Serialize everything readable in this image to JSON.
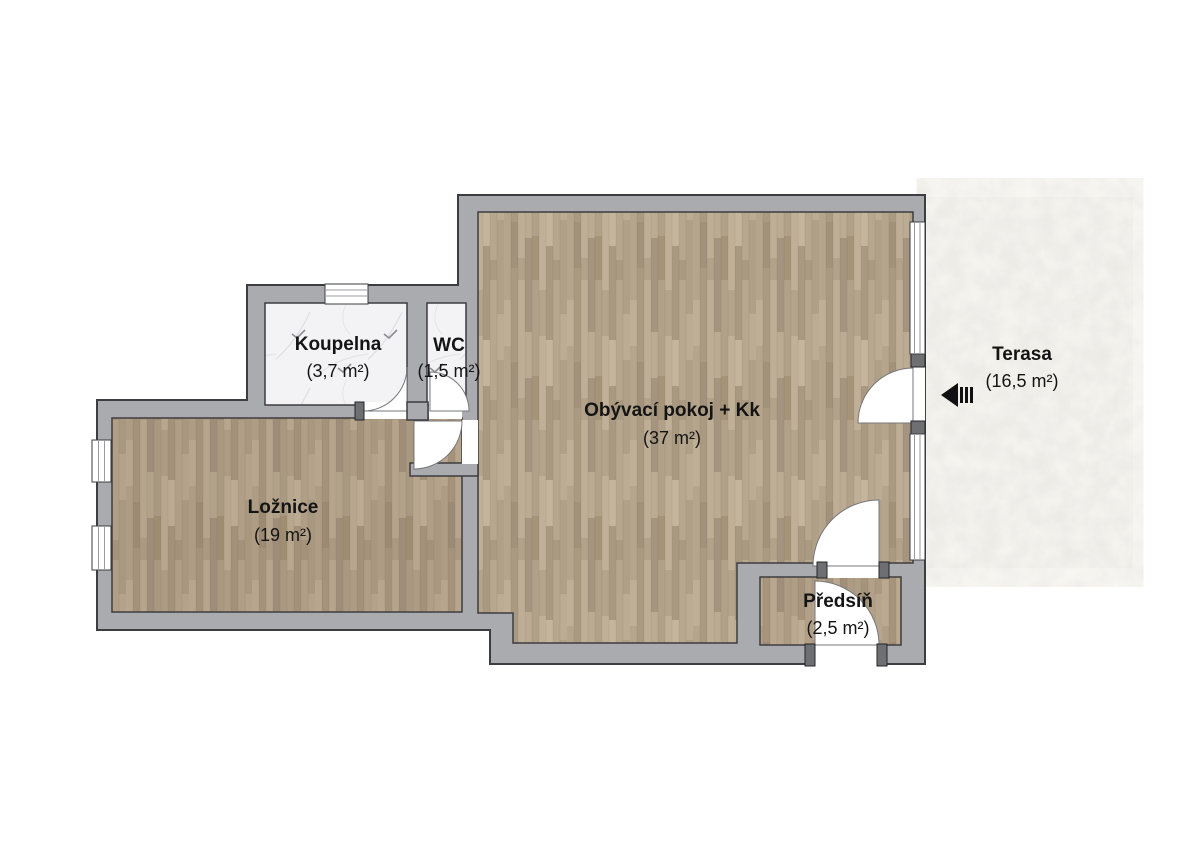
{
  "plan": {
    "type": "apartment-floor-plan",
    "rooms": [
      {
        "id": "koupelna",
        "name": "Koupelna",
        "area": "(3,7 m²)"
      },
      {
        "id": "wc",
        "name": "WC",
        "area": "(1,5 m²)"
      },
      {
        "id": "obyvaci",
        "name": "Obývací pokoj + Kk",
        "area": "(37 m²)"
      },
      {
        "id": "loznice",
        "name": "Ložnice",
        "area": "(19 m²)"
      },
      {
        "id": "predsin",
        "name": "Předsíň",
        "area": "(2,5 m²)"
      },
      {
        "id": "terasa",
        "name": "Terasa",
        "area": "(16,5 m²)"
      }
    ],
    "icons": [
      {
        "name": "entrance-arrow-icon",
        "meaning": "entrance direction from terrace",
        "direction": "left"
      }
    ]
  },
  "colors": {
    "wall": "#aaabaf",
    "outline": "#3c3d41",
    "label": "#141414",
    "arrow": "#111111",
    "wood": "#b3a28b",
    "marble": "#f3f3f5",
    "stone": "#dedad2",
    "background": "#ffffff"
  }
}
